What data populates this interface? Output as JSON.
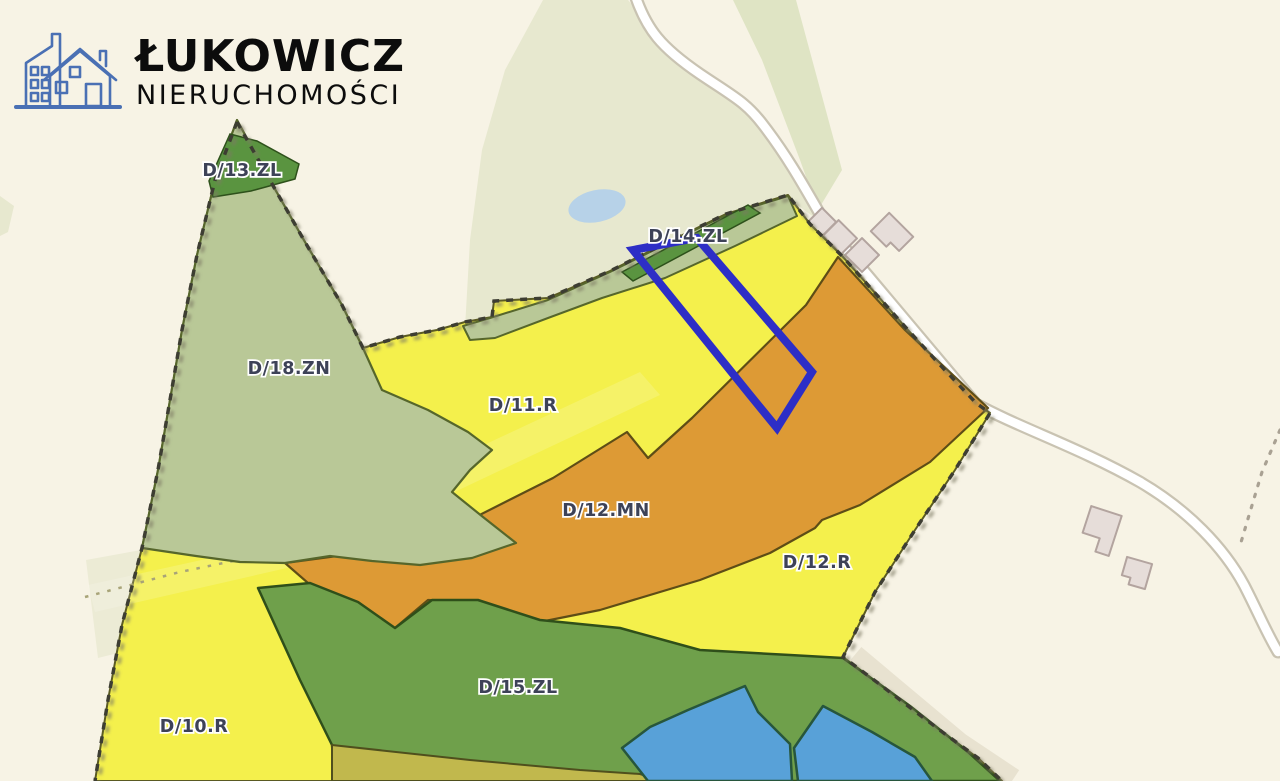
{
  "logo": {
    "title": "ŁUKOWICZ",
    "subtitle": "NIERUCHOMOŚCI",
    "icon": "buildings-house-icon"
  },
  "map": {
    "type": "zoning-plan-map",
    "zones": [
      {
        "label": "D/13.ZL",
        "color": "#b9c897"
      },
      {
        "label": "D/14.ZL",
        "color": "#b9c897"
      },
      {
        "label": "D/18.ZN",
        "color": "#b9c897"
      },
      {
        "label": "D/11.R",
        "color": "#f4f04c"
      },
      {
        "label": "D/12.MN",
        "color": "#dd9a35"
      },
      {
        "label": "D/12.R",
        "color": "#f4f04c"
      },
      {
        "label": "D/15.ZL",
        "color": "#6fa04b"
      },
      {
        "label": "D/10.R",
        "color": "#f4f04c"
      }
    ],
    "colors": {
      "background": "#f7f3e5",
      "pale_area": "#e7e8cf",
      "pale_band": "#dfe4c4",
      "pond": "#b7d2e8",
      "road_casing": "#c9c3b2",
      "road_fill": "#ffffff",
      "side_trail": "#e8e2d0",
      "dark_green": "#5a9440",
      "olive": "#c1b84d",
      "water": "#58a1d8",
      "boundary": "#3e3e33",
      "highlight": "#2d2ec6",
      "building_fill": "#e6ddd9",
      "building_stroke": "#b3a49f",
      "label_text": "#3d4257"
    },
    "highlighted_parcel": {
      "outline_color": "#2d2ec6",
      "location": "D/14.ZL / D/11.R / D/12.MN strip"
    }
  }
}
